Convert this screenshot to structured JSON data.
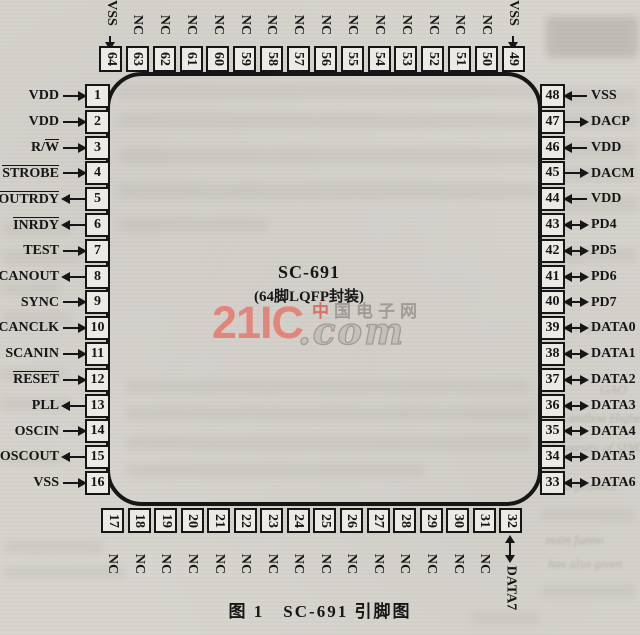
{
  "figure": {
    "chip_name": "SC-691",
    "package_label": "(64脚LQFP封装)",
    "caption": "图 1　SC-691 引脚图"
  },
  "watermark": {
    "brand": "21IC",
    "suffix": ".com",
    "site_first": "中",
    "site_rest": "国电子网",
    "brand_color": "#e5786c",
    "gray_color": "#9b968f"
  },
  "colors": {
    "paper": "#d8d5cf",
    "ink": "#161616"
  },
  "pins": {
    "left": [
      {
        "num": "1",
        "label_plain": "VDD",
        "label_over": "",
        "dir": "in"
      },
      {
        "num": "2",
        "label_plain": "VDD",
        "label_over": "",
        "dir": "in"
      },
      {
        "num": "3",
        "label_plain": "R/",
        "label_over": "W",
        "dir": "in"
      },
      {
        "num": "4",
        "label_plain": "",
        "label_over": "STROBE",
        "dir": "in"
      },
      {
        "num": "5",
        "label_plain": "",
        "label_over": "OUTRDY",
        "dir": "out"
      },
      {
        "num": "6",
        "label_plain": "",
        "label_over": "INRDY",
        "dir": "out"
      },
      {
        "num": "7",
        "label_plain": "TEST",
        "label_over": "",
        "dir": "in"
      },
      {
        "num": "8",
        "label_plain": "SCANOUT",
        "label_over": "",
        "dir": "out"
      },
      {
        "num": "9",
        "label_plain": "SYNC",
        "label_over": "",
        "dir": "in"
      },
      {
        "num": "10",
        "label_plain": "SCANCLK",
        "label_over": "",
        "dir": "in"
      },
      {
        "num": "11",
        "label_plain": "SCANIN",
        "label_over": "",
        "dir": "in"
      },
      {
        "num": "12",
        "label_plain": "",
        "label_over": "RESET",
        "dir": "in"
      },
      {
        "num": "13",
        "label_plain": "PLL",
        "label_over": "",
        "dir": "out"
      },
      {
        "num": "14",
        "label_plain": "OSCIN",
        "label_over": "",
        "dir": "in"
      },
      {
        "num": "15",
        "label_plain": "OSCOUT",
        "label_over": "",
        "dir": "out"
      },
      {
        "num": "16",
        "label_plain": "VSS",
        "label_over": "",
        "dir": "in"
      }
    ],
    "right": [
      {
        "num": "48",
        "label": "VSS",
        "dir": "in"
      },
      {
        "num": "47",
        "label": "DACP",
        "dir": "out"
      },
      {
        "num": "46",
        "label": "VDD",
        "dir": "in"
      },
      {
        "num": "45",
        "label": "DACM",
        "dir": "out"
      },
      {
        "num": "44",
        "label": "VDD",
        "dir": "in"
      },
      {
        "num": "43",
        "label": "PD4",
        "dir": "bidir"
      },
      {
        "num": "42",
        "label": "PD5",
        "dir": "bidir"
      },
      {
        "num": "41",
        "label": "PD6",
        "dir": "bidir"
      },
      {
        "num": "40",
        "label": "PD7",
        "dir": "bidir"
      },
      {
        "num": "39",
        "label": "DATA0",
        "dir": "bidir"
      },
      {
        "num": "38",
        "label": "DATA1",
        "dir": "bidir"
      },
      {
        "num": "37",
        "label": "DATA2",
        "dir": "bidir"
      },
      {
        "num": "36",
        "label": "DATA3",
        "dir": "bidir"
      },
      {
        "num": "35",
        "label": "DATA4",
        "dir": "bidir"
      },
      {
        "num": "34",
        "label": "DATA5",
        "dir": "bidir"
      },
      {
        "num": "33",
        "label": "DATA6",
        "dir": "bidir"
      }
    ],
    "top": [
      {
        "num": "64",
        "label": "VSS",
        "dir": "in"
      },
      {
        "num": "63",
        "label": "NC",
        "dir": ""
      },
      {
        "num": "62",
        "label": "NC",
        "dir": ""
      },
      {
        "num": "61",
        "label": "NC",
        "dir": ""
      },
      {
        "num": "60",
        "label": "NC",
        "dir": ""
      },
      {
        "num": "59",
        "label": "NC",
        "dir": ""
      },
      {
        "num": "58",
        "label": "NC",
        "dir": ""
      },
      {
        "num": "57",
        "label": "NC",
        "dir": ""
      },
      {
        "num": "56",
        "label": "NC",
        "dir": ""
      },
      {
        "num": "55",
        "label": "NC",
        "dir": ""
      },
      {
        "num": "54",
        "label": "NC",
        "dir": ""
      },
      {
        "num": "53",
        "label": "NC",
        "dir": ""
      },
      {
        "num": "52",
        "label": "NC",
        "dir": ""
      },
      {
        "num": "51",
        "label": "NC",
        "dir": ""
      },
      {
        "num": "50",
        "label": "NC",
        "dir": ""
      },
      {
        "num": "49",
        "label": "VSS",
        "dir": "in"
      }
    ],
    "bottom": [
      {
        "num": "17",
        "label": "NC",
        "dir": ""
      },
      {
        "num": "18",
        "label": "NC",
        "dir": ""
      },
      {
        "num": "19",
        "label": "NC",
        "dir": ""
      },
      {
        "num": "20",
        "label": "NC",
        "dir": ""
      },
      {
        "num": "21",
        "label": "NC",
        "dir": ""
      },
      {
        "num": "22",
        "label": "NC",
        "dir": ""
      },
      {
        "num": "23",
        "label": "NC",
        "dir": ""
      },
      {
        "num": "24",
        "label": "NC",
        "dir": ""
      },
      {
        "num": "25",
        "label": "NC",
        "dir": ""
      },
      {
        "num": "26",
        "label": "NC",
        "dir": ""
      },
      {
        "num": "27",
        "label": "NC",
        "dir": ""
      },
      {
        "num": "28",
        "label": "NC",
        "dir": ""
      },
      {
        "num": "29",
        "label": "NC",
        "dir": ""
      },
      {
        "num": "30",
        "label": "NC",
        "dir": ""
      },
      {
        "num": "31",
        "label": "NC",
        "dir": ""
      },
      {
        "num": "32",
        "label": "DATA7",
        "dir": "bidir"
      }
    ]
  },
  "background_ghost": {
    "fragments": [
      "Drivers for",
      "GAO",
      "of Lanzhou Higher Polytechnic",
      "University of SINOPEC",
      "board-produce",
      "main funno",
      "has also given"
    ]
  }
}
